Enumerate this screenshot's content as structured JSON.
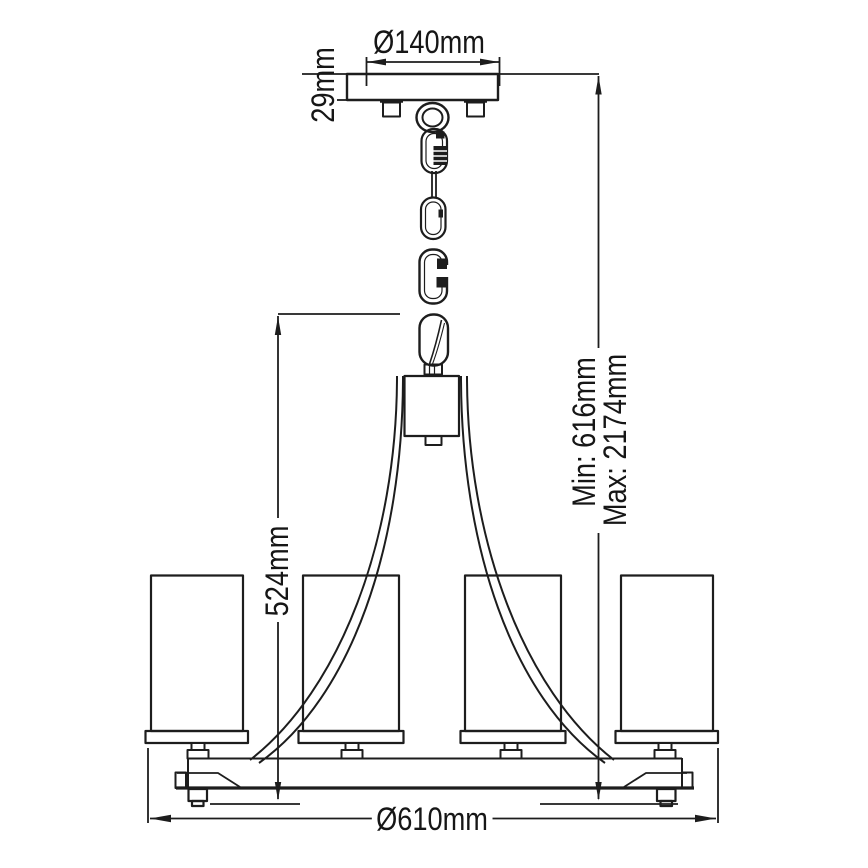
{
  "page": {
    "background_color": "#ffffff",
    "line_color": "#1d1d1d",
    "description_of_visible_content": "black-and-white technical dimension drawing of a 4-light chandelier hanging on a chain"
  },
  "dimensions": {
    "canopy_diameter": {
      "label": "Ø140mm",
      "value_mm": 140,
      "orientation": "horizontal"
    },
    "canopy_height": {
      "label": "29mm",
      "value_mm": 29,
      "orientation": "vertical"
    },
    "body_height": {
      "label": "524mm",
      "value_mm": 524,
      "orientation": "vertical"
    },
    "min_drop": {
      "label": "Min: 616mm",
      "value_mm": 616,
      "orientation": "vertical"
    },
    "max_drop": {
      "label": "Max: 2174mm",
      "value_mm": 2174,
      "orientation": "vertical"
    },
    "fixture_diameter": {
      "label": "Ø610mm",
      "value_mm": 610,
      "orientation": "horizontal"
    }
  }
}
